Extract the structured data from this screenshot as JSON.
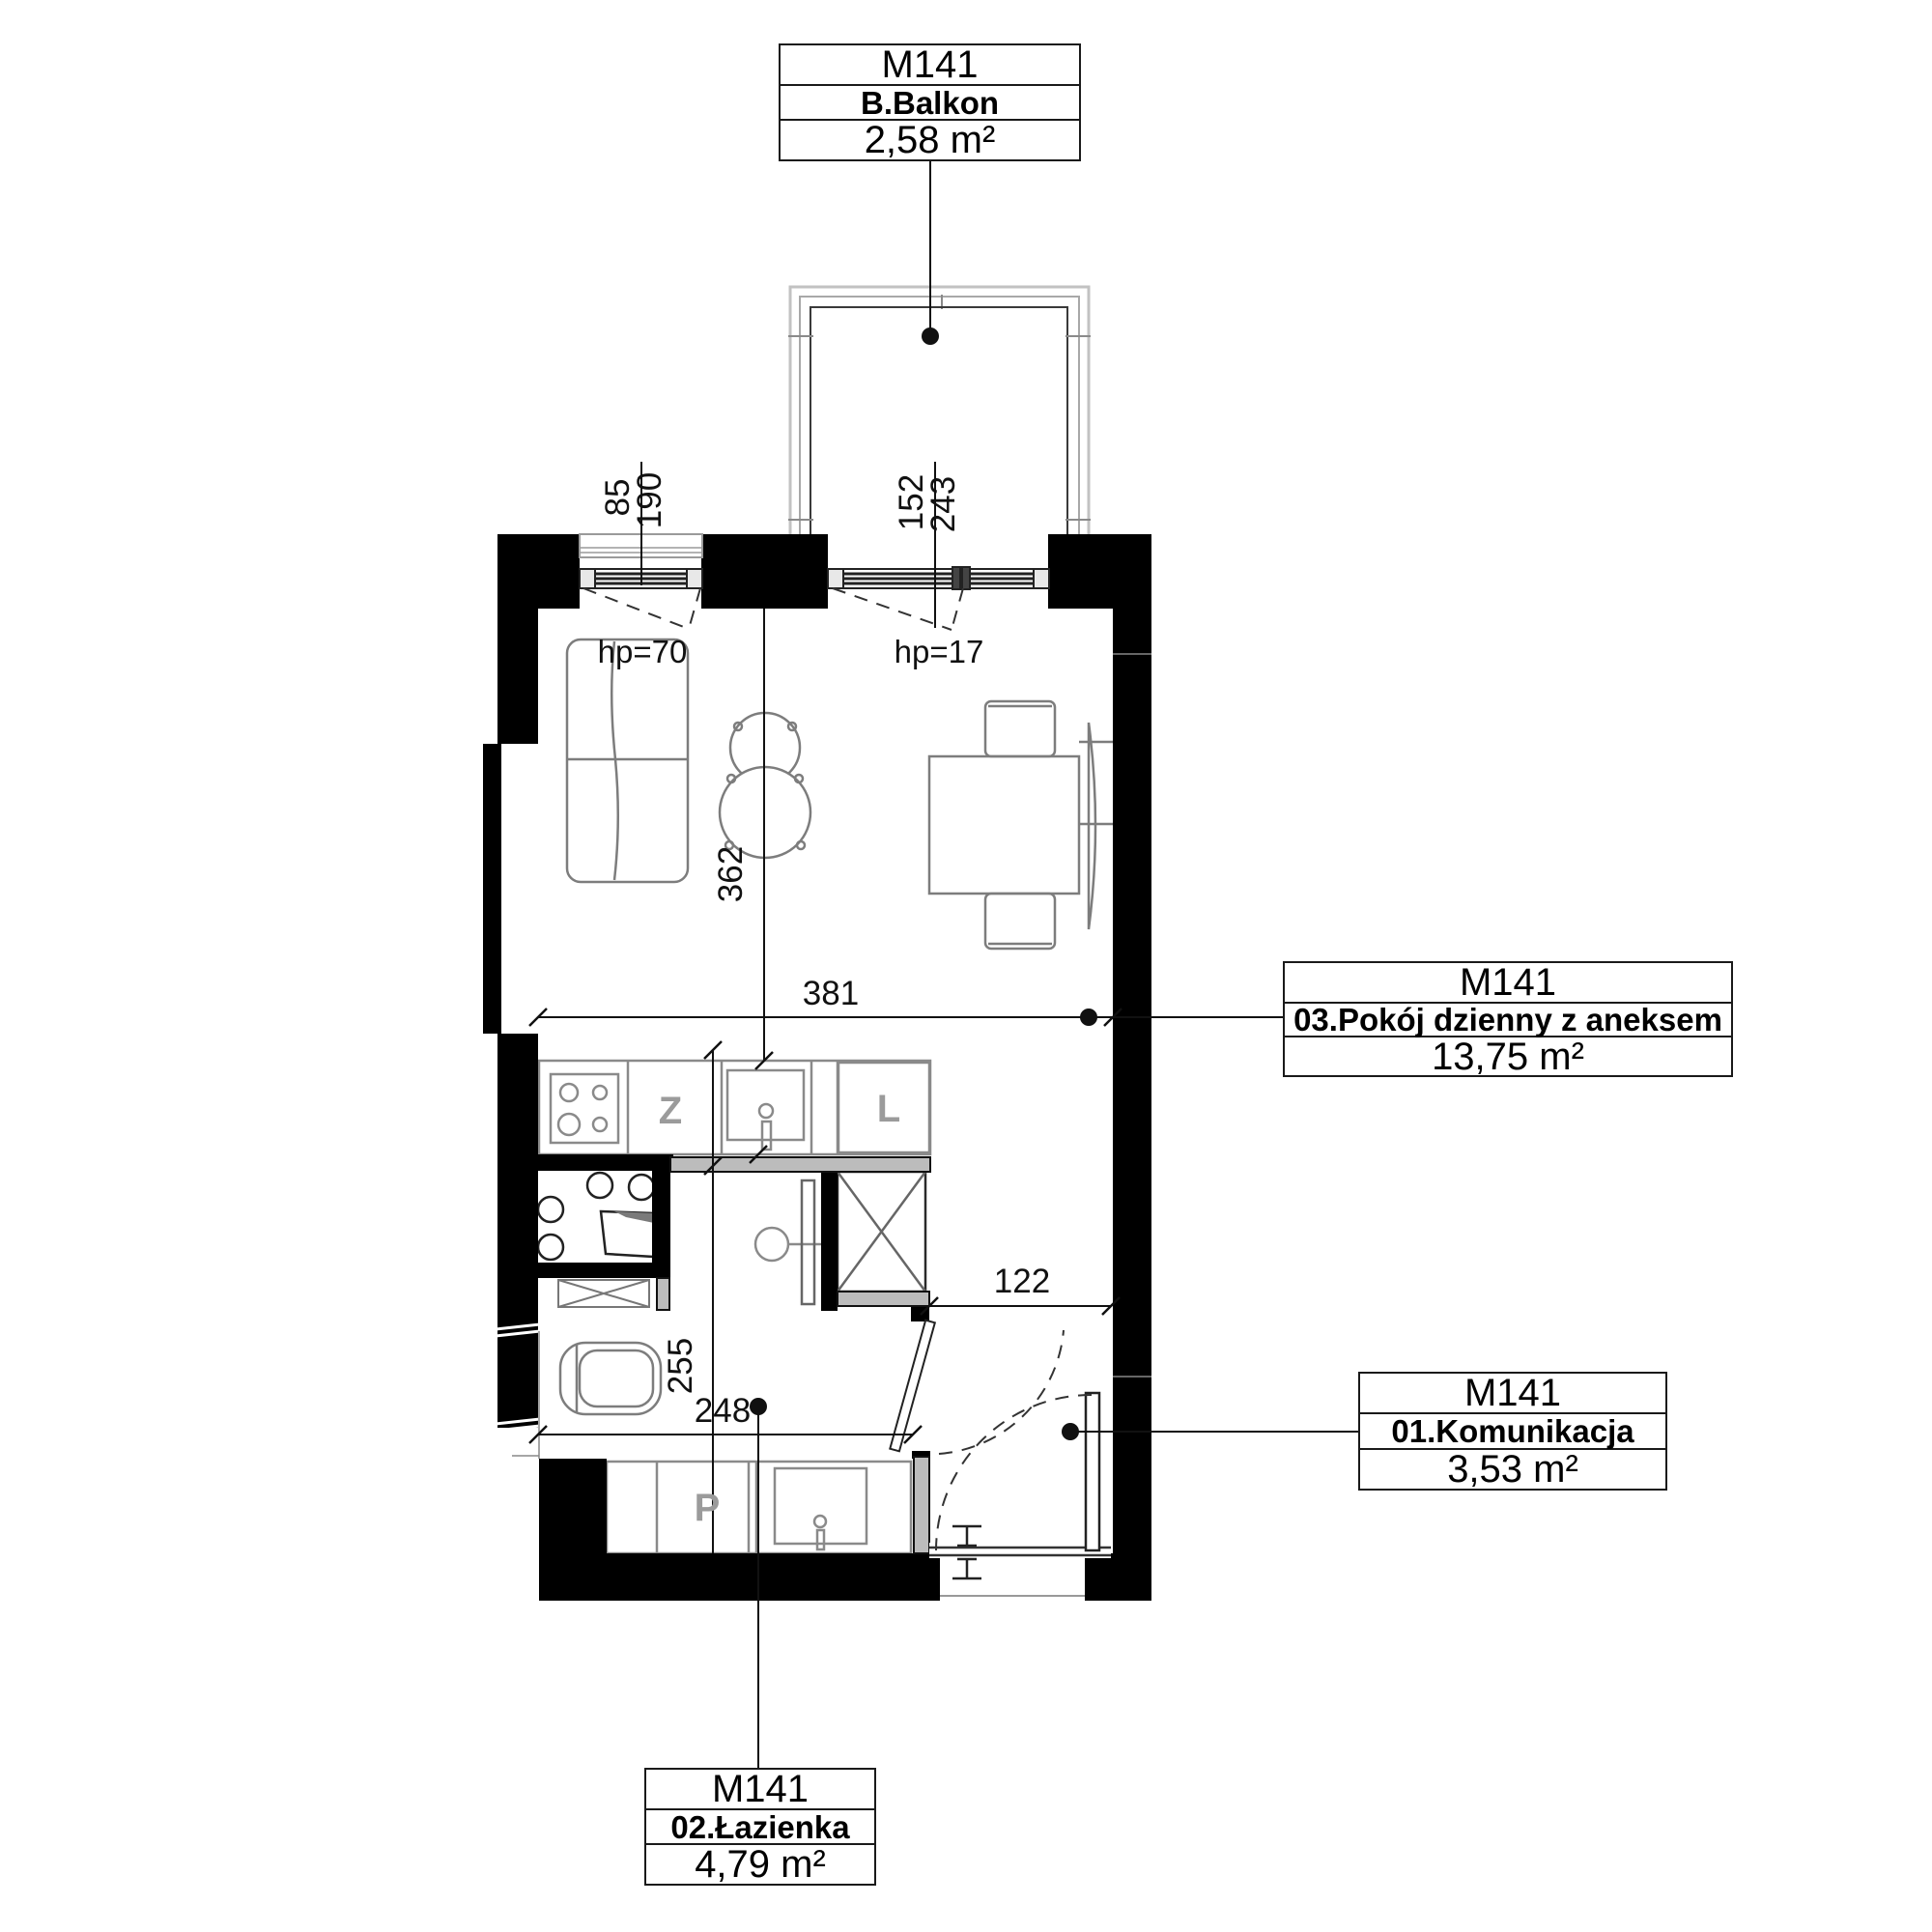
{
  "plan": {
    "title": "Floor plan unit M141",
    "unit_labels": {
      "balkon": {
        "code": "M141",
        "name": "B.Balkon",
        "area": "2,58 m²"
      },
      "pokoj": {
        "code": "M141",
        "name": "03.Pokój dzienny z aneksem",
        "area": "13,75 m²"
      },
      "komunikacja": {
        "code": "M141",
        "name": "01.Komunikacja",
        "area": "3,53 m²"
      },
      "lazienka": {
        "code": "M141",
        "name": "02.Łazienka",
        "area": "4,79 m²"
      }
    },
    "dimensions": {
      "living_width": "381",
      "living_depth": "362",
      "window_left_a": "85",
      "window_left_b": "190",
      "balcony_window_a": "152",
      "balcony_window_b": "243",
      "hp_left": "hp=70",
      "hp_balcony": "hp=17",
      "corridor_width": "122",
      "bath_width": "248",
      "bath_depth": "255"
    },
    "fixture_letters": {
      "z": "Z",
      "l": "L",
      "p": "P"
    },
    "colors": {
      "wall": "#000000",
      "partition": "#bcbcbc",
      "furniture": "#7d7d7d",
      "dim": "#111111",
      "balcony_outline": "#b5b5b5"
    }
  }
}
